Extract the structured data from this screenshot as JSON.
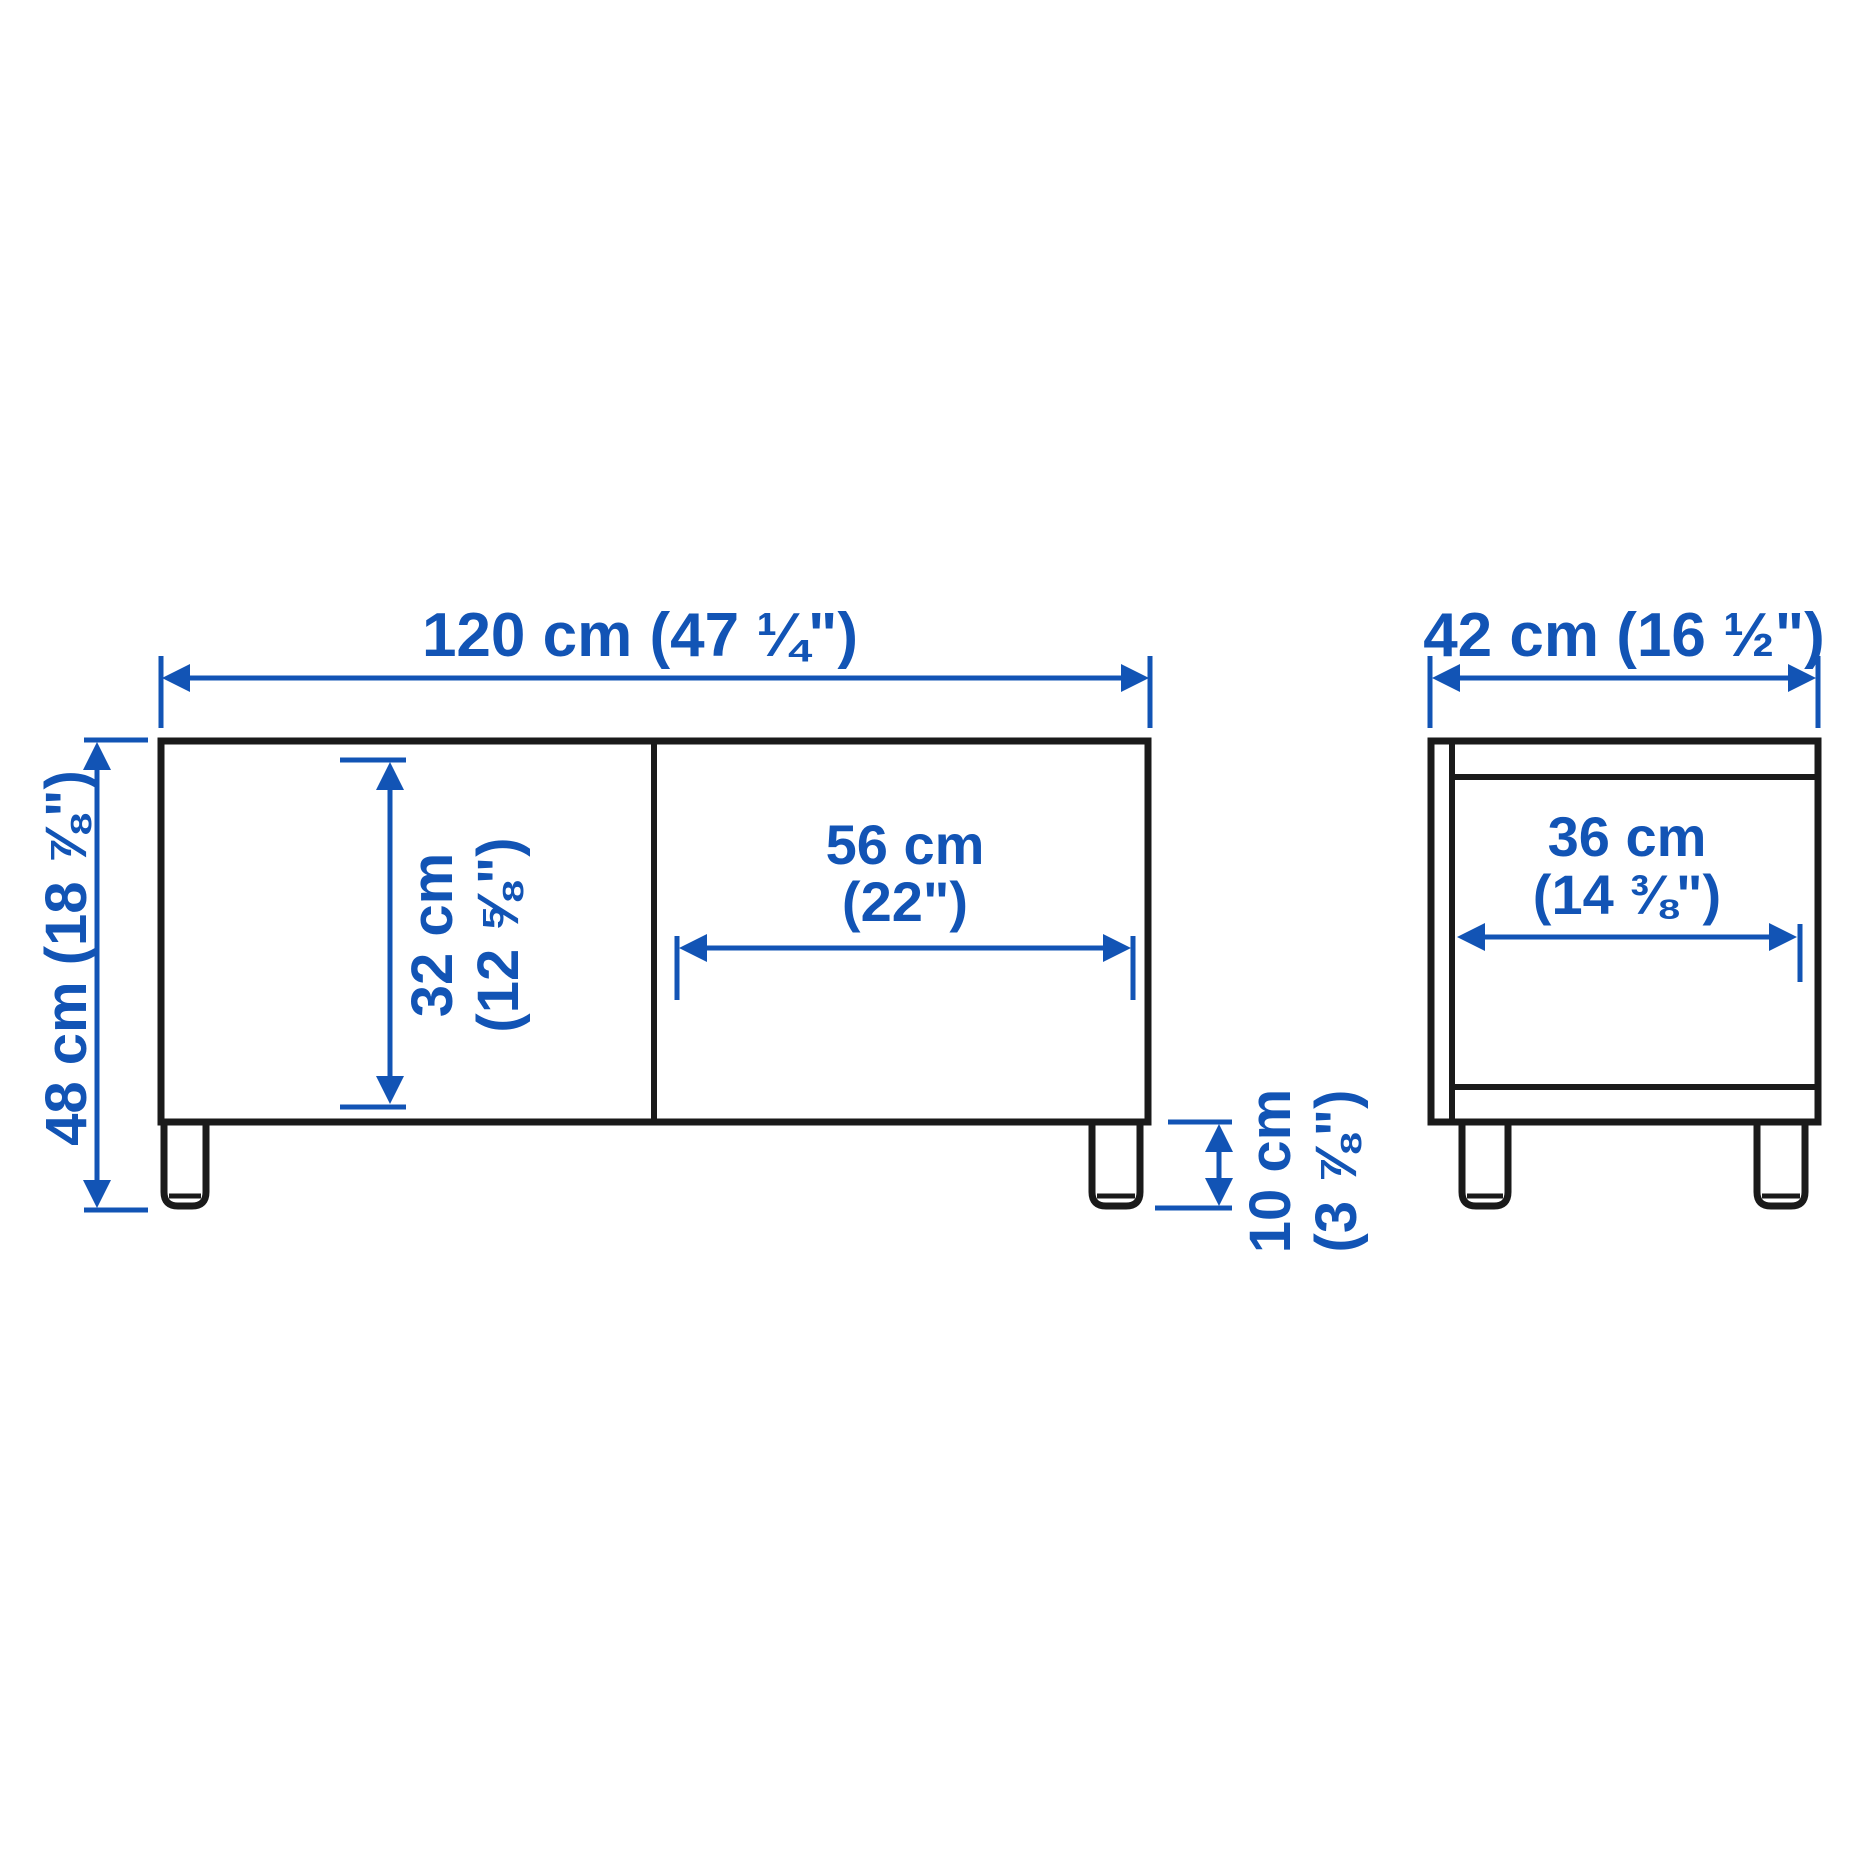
{
  "page": {
    "background": "#ffffff"
  },
  "colors": {
    "accent_blue": "#1254b5",
    "outline_black": "#1a1a1a"
  },
  "front_view": {
    "overall_width": {
      "label": "120 cm (47 ¼\")"
    },
    "overall_height": {
      "label": "48 cm (18 ⅞\")"
    },
    "door_height": {
      "line1": "32 cm",
      "line2": "(12 ⅝\")"
    },
    "drawer_width": {
      "line1": "56 cm",
      "line2": "(22\")"
    },
    "leg_height": {
      "line1": "10 cm",
      "line2": "(3 ⅞\")"
    }
  },
  "side_view": {
    "depth": {
      "label": "42 cm (16 ½\")"
    },
    "inner_width": {
      "line1": "36 cm",
      "line2": "(14 ⅜\")"
    }
  }
}
